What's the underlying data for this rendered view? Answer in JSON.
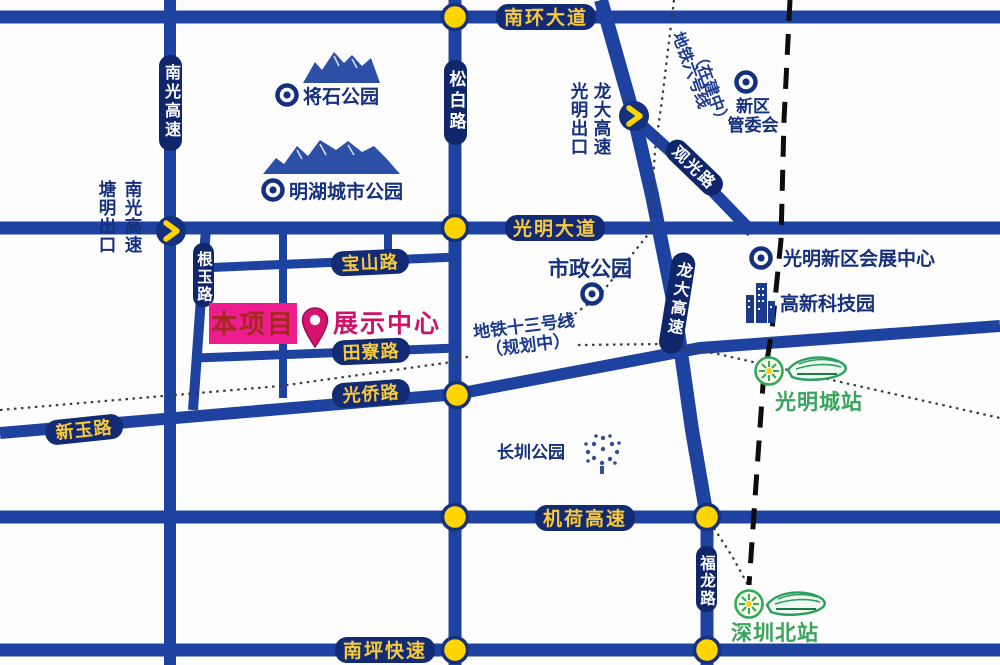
{
  "roads": {
    "nanhuan_ave": "南环大道",
    "guangming_ave": "光明大道",
    "jihe_expwy": "机荷高速",
    "nanping_expwy": "南坪快速",
    "songbai_rd": "松白路",
    "nanguang_expwy": "南光高速",
    "longda_expwy": "龙大高速",
    "fulong_rd": "福龙路",
    "guanguang_rd": "观光路",
    "baoshan_rd": "宝山路",
    "tianliao_rd": "田寮路",
    "guangqiao_rd": "光侨路",
    "xinyu_rd": "新玉路",
    "genyu_rd": "根玉路"
  },
  "exits": {
    "tangming": {
      "expressway": "南光高速",
      "exit": "塘明出口"
    },
    "guangming": {
      "expressway": "龙大高速",
      "exit": "光明出口"
    }
  },
  "metro_lines": {
    "line13_name": "地铁十三号线",
    "line13_status": "（规划中）",
    "line6_name": "地铁六号线",
    "line6_status": "（在建中）"
  },
  "parks": {
    "jiangshi": "将石公园",
    "minghu": "明湖城市公园",
    "municipal": "市政公园",
    "changzhen": "长圳公园"
  },
  "landmarks": {
    "district_committee_line1": "新区",
    "district_committee_line2": "管委会",
    "convention_center": "光明新区会展中心",
    "hightech_park": "高新科技园"
  },
  "stations": {
    "guangmingcheng": "光明城站",
    "shenzhenbei": "深圳北站"
  },
  "project": {
    "site_label": "本项目",
    "exhibition_center": "展示中心"
  },
  "colors": {
    "road_blue": "#1e429f",
    "pill_navy": "#122b74",
    "label_gold": "#f7c93c",
    "node_yellow": "#ffd400",
    "magenta": "#ee1d8e",
    "station_green": "#3aa35c",
    "text_navy": "#15307c"
  }
}
